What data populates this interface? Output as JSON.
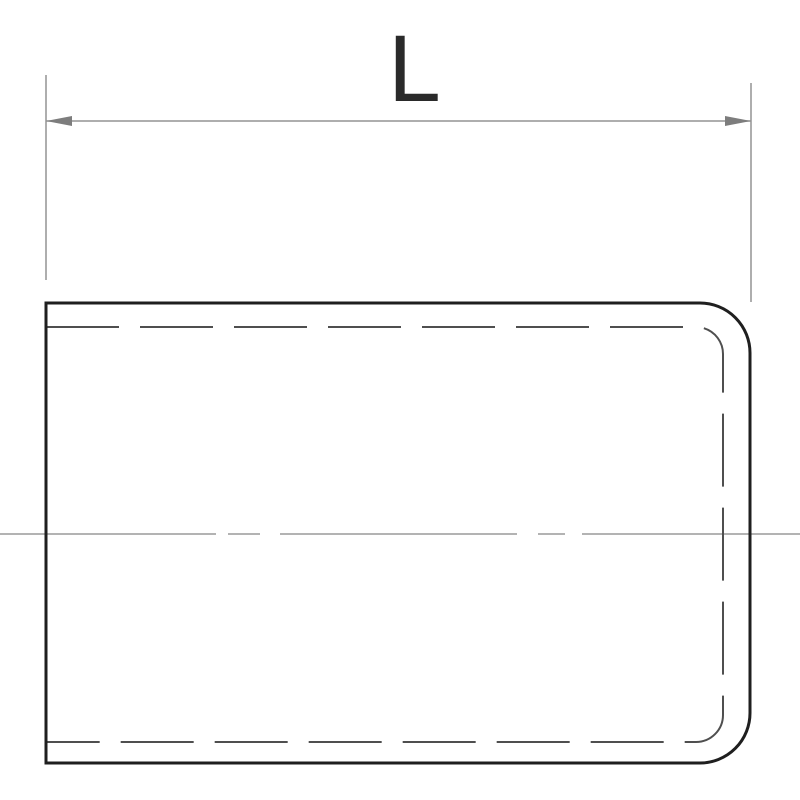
{
  "drawing": {
    "title": "technical drawing of capped tube profile with length dimension",
    "dimension": {
      "label": "L"
    },
    "colors": {
      "background": "#ffffff",
      "outline": "#1f1f1f",
      "hidden_line": "#4f4f4f",
      "dimension_line": "#949494",
      "arrowhead": "#7d7d7d",
      "centerline": "#9a9a9a",
      "label": "#2a2a2a"
    }
  }
}
